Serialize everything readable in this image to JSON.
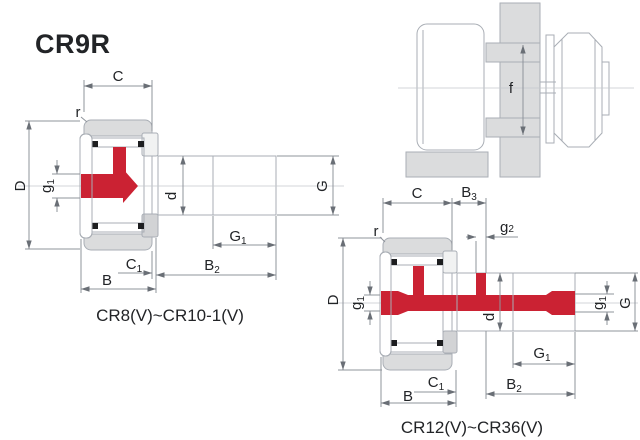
{
  "title": "CR9R",
  "figure1": {
    "caption": "CR8(V)~CR10-1(V)",
    "dims": {
      "C": {
        "main": "C",
        "sub": ""
      },
      "r": {
        "main": "r",
        "sub": ""
      },
      "D": {
        "main": "D",
        "sub": ""
      },
      "g1": {
        "main": "g",
        "sub": "1"
      },
      "d": {
        "main": "d",
        "sub": ""
      },
      "G": {
        "main": "G",
        "sub": ""
      },
      "G1": {
        "main": "G",
        "sub": "1"
      },
      "B2": {
        "main": "B",
        "sub": "2"
      },
      "C1": {
        "main": "C",
        "sub": "1"
      },
      "B": {
        "main": "B",
        "sub": ""
      }
    }
  },
  "figure2": {
    "caption": "CR12(V)~CR36(V)",
    "dims": {
      "C": {
        "main": "C",
        "sub": ""
      },
      "B3": {
        "main": "B",
        "sub": "3"
      },
      "g2": {
        "main": "g",
        "sub": "2"
      },
      "r": {
        "main": "r",
        "sub": ""
      },
      "D": {
        "main": "D",
        "sub": ""
      },
      "g1_left": {
        "main": "g",
        "sub": "1"
      },
      "d": {
        "main": "d",
        "sub": ""
      },
      "g1_right": {
        "main": "g",
        "sub": "1"
      },
      "G": {
        "main": "G",
        "sub": ""
      },
      "G1": {
        "main": "G",
        "sub": "1"
      },
      "B2": {
        "main": "B",
        "sub": "2"
      },
      "C1": {
        "main": "C",
        "sub": "1"
      },
      "B": {
        "main": "B",
        "sub": ""
      }
    }
  },
  "figure3": {
    "dims": {
      "f": {
        "main": "f",
        "sub": ""
      }
    }
  },
  "colors": {
    "grease_red": "#cb2233",
    "part_gray": "#dbdcdd",
    "line_gray": "#a9aeb5",
    "dim_line_gray": "#8f949b",
    "text_color": "#222427"
  }
}
